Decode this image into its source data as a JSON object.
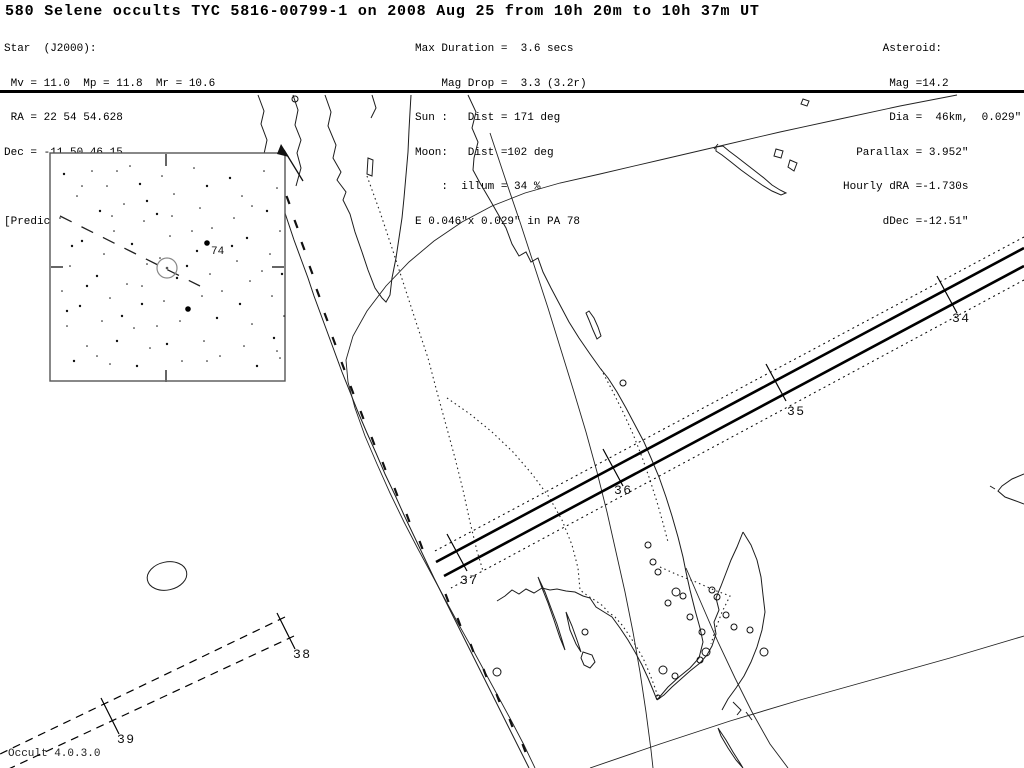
{
  "title": "580 Selene occults TYC 5816-00799-1 on 2008 Aug 25 from 10h 20m to 10h 37m UT",
  "header": {
    "left": {
      "lines": [
        "Star  (J2000):",
        " Mv = 11.0  Mp = 11.8  Mr = 10.6",
        " RA = 22 54 54.628",
        "Dec = -11 50 46.15",
        " ",
        "[Prediction of 2008 Jul 25.0]"
      ]
    },
    "center": {
      "lines": [
        "Max Duration =  3.6 secs",
        "    Mag Drop =  3.3 (3.2r)",
        "Sun :   Dist = 171 deg",
        "Moon:   Dist =102 deg",
        "    :  illum = 34 %",
        "E 0.046\"x 0.029\" in PA 78"
      ]
    },
    "right": {
      "lines": [
        "      Asteroid:",
        "       Mag =14.2",
        "       Dia =  46km,  0.029\"",
        "  Parallax = 3.952\"",
        "Hourly dRA =-1.730s",
        "      dDec =-12.51\""
      ]
    }
  },
  "map": {
    "time_tick_labels": [
      "34",
      "35",
      "36",
      "37",
      "38",
      "39"
    ],
    "credit": "Occult 4.0.3.0",
    "colors": {
      "ink": "#000000",
      "line": "#1c1c1c",
      "gray": "#666666"
    },
    "cities": [
      [
        295,
        99,
        3
      ],
      [
        623,
        383,
        3
      ],
      [
        497,
        672,
        4
      ],
      [
        585,
        632,
        3
      ],
      [
        648,
        545,
        3
      ],
      [
        653,
        562,
        3
      ],
      [
        658,
        572,
        3
      ],
      [
        668,
        603,
        3
      ],
      [
        676,
        592,
        4
      ],
      [
        683,
        596,
        3
      ],
      [
        690,
        617,
        3
      ],
      [
        702,
        632,
        3
      ],
      [
        706,
        652,
        4
      ],
      [
        700,
        660,
        3
      ],
      [
        663,
        670,
        4
      ],
      [
        675,
        676,
        3
      ],
      [
        712,
        590,
        3
      ],
      [
        717,
        597,
        3
      ],
      [
        726,
        615,
        3
      ],
      [
        734,
        627,
        3
      ],
      [
        750,
        630,
        3
      ],
      [
        764,
        652,
        4
      ],
      [
        658,
        697,
        2
      ]
    ]
  },
  "inset": {
    "bright_star_label": "74",
    "stars": [
      [
        12,
        18
      ],
      [
        25,
        40
      ],
      [
        8,
        62
      ],
      [
        30,
        85
      ],
      [
        18,
        110
      ],
      [
        10,
        135
      ],
      [
        28,
        150
      ],
      [
        15,
        170
      ],
      [
        35,
        190
      ],
      [
        22,
        205
      ],
      [
        40,
        15
      ],
      [
        55,
        30
      ],
      [
        48,
        55
      ],
      [
        62,
        75
      ],
      [
        52,
        98
      ],
      [
        45,
        120
      ],
      [
        58,
        142
      ],
      [
        50,
        165
      ],
      [
        65,
        185
      ],
      [
        58,
        208
      ],
      [
        78,
        10
      ],
      [
        88,
        28
      ],
      [
        72,
        48
      ],
      [
        92,
        65
      ],
      [
        80,
        88
      ],
      [
        95,
        108
      ],
      [
        75,
        128
      ],
      [
        90,
        148
      ],
      [
        82,
        172
      ],
      [
        98,
        192
      ],
      [
        85,
        210
      ],
      [
        110,
        20
      ],
      [
        122,
        38
      ],
      [
        105,
        58
      ],
      [
        118,
        80
      ],
      [
        108,
        102
      ],
      [
        125,
        122
      ],
      [
        112,
        145
      ],
      [
        128,
        165
      ],
      [
        115,
        188
      ],
      [
        130,
        205
      ],
      [
        142,
        12
      ],
      [
        155,
        30
      ],
      [
        148,
        52
      ],
      [
        160,
        72
      ],
      [
        145,
        95
      ],
      [
        158,
        118
      ],
      [
        150,
        140
      ],
      [
        165,
        162
      ],
      [
        152,
        185
      ],
      [
        168,
        200
      ],
      [
        178,
        22
      ],
      [
        190,
        40
      ],
      [
        182,
        62
      ],
      [
        195,
        82
      ],
      [
        185,
        105
      ],
      [
        198,
        125
      ],
      [
        188,
        148
      ],
      [
        200,
        168
      ],
      [
        192,
        190
      ],
      [
        205,
        210
      ],
      [
        212,
        15
      ],
      [
        225,
        32
      ],
      [
        215,
        55
      ],
      [
        228,
        75
      ],
      [
        218,
        98
      ],
      [
        230,
        118
      ],
      [
        220,
        140
      ],
      [
        232,
        160
      ],
      [
        222,
        182
      ],
      [
        228,
        202
      ],
      [
        30,
        30
      ],
      [
        70,
        160
      ],
      [
        140,
        75
      ],
      [
        90,
        130
      ],
      [
        180,
        90
      ],
      [
        60,
        60
      ],
      [
        200,
        50
      ],
      [
        35,
        130
      ],
      [
        170,
        135
      ],
      [
        120,
        60
      ],
      [
        20,
        90
      ],
      [
        105,
        170
      ],
      [
        65,
        15
      ],
      [
        135,
        110
      ],
      [
        210,
        115
      ],
      [
        45,
        200
      ],
      [
        95,
        45
      ],
      [
        155,
        205
      ],
      [
        225,
        195
      ],
      [
        15,
        155
      ]
    ]
  }
}
